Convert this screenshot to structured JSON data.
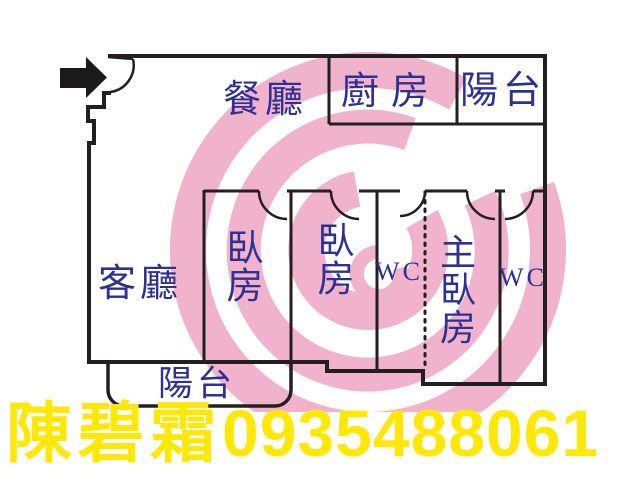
{
  "plan": {
    "wall_color": "#231f20",
    "label_color": "#2e3192",
    "watermark_color": "#f0b3cb",
    "rooms": [
      {
        "id": "dining",
        "label": "餐廳"
      },
      {
        "id": "kitchen",
        "label": "廚房"
      },
      {
        "id": "balcony-top",
        "label": "陽台"
      },
      {
        "id": "living",
        "label": "客廳"
      },
      {
        "id": "bedroom-1",
        "label": "臥房"
      },
      {
        "id": "bedroom-2",
        "label": "臥房"
      },
      {
        "id": "wc-1",
        "label": "WC"
      },
      {
        "id": "master-bedroom",
        "label": "主臥房"
      },
      {
        "id": "wc-2",
        "label": "WC"
      },
      {
        "id": "balcony-bottom",
        "label": "陽台"
      }
    ]
  },
  "contact": {
    "name": "陳碧霜",
    "phone": "0935488061",
    "color": "#ffe808"
  }
}
